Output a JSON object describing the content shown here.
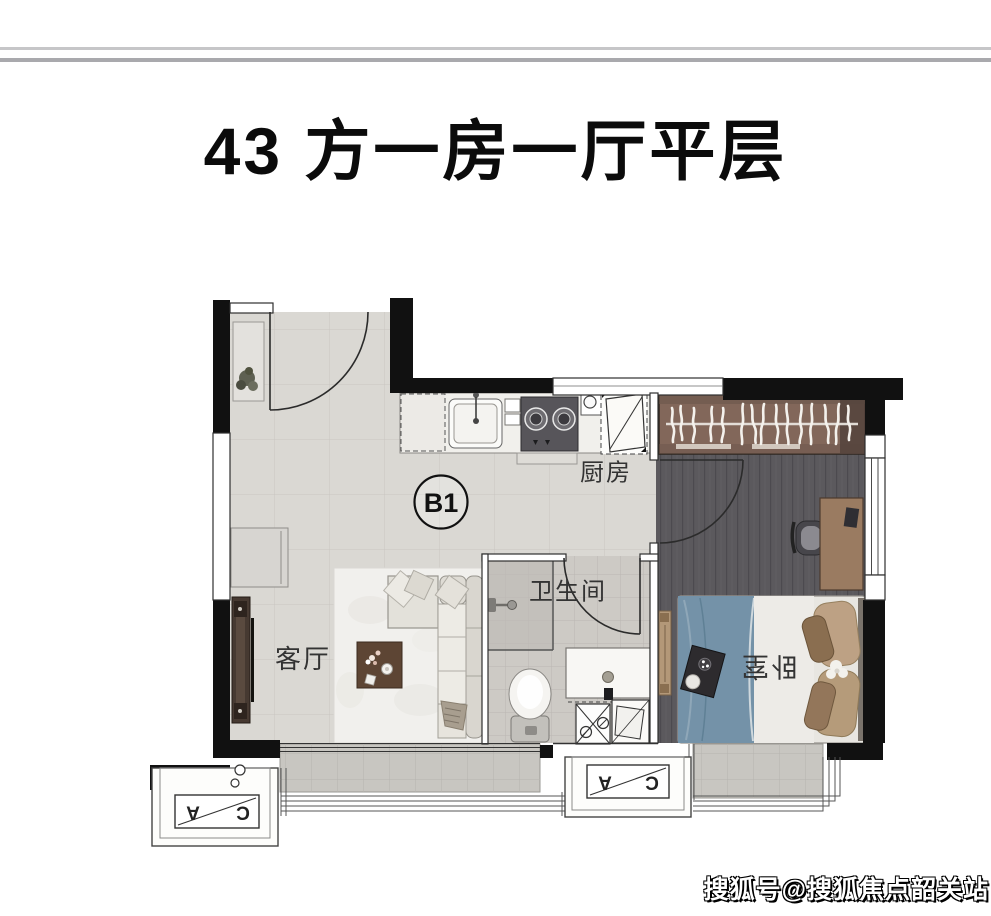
{
  "header": {
    "title": "43 方一房一厅平层"
  },
  "floorplan": {
    "unit_badge": "B1",
    "rooms": {
      "kitchen": "厨房",
      "bathroom": "卫生间",
      "living": "客厅",
      "bedroom": "卧室"
    },
    "ac_unit": {
      "letter_a": "A",
      "letter_c": "C"
    },
    "colors": {
      "wall": "#111111",
      "bed_blanket_blue": "#7492a8",
      "coffee_table_wood": "#5d4534",
      "wardrobe_wood": "#82675a",
      "desk_wood": "#9a7b61",
      "bedroom_floor": "#5b595d"
    }
  },
  "watermark": {
    "text": "搜狐号@搜狐焦点韶关站"
  }
}
